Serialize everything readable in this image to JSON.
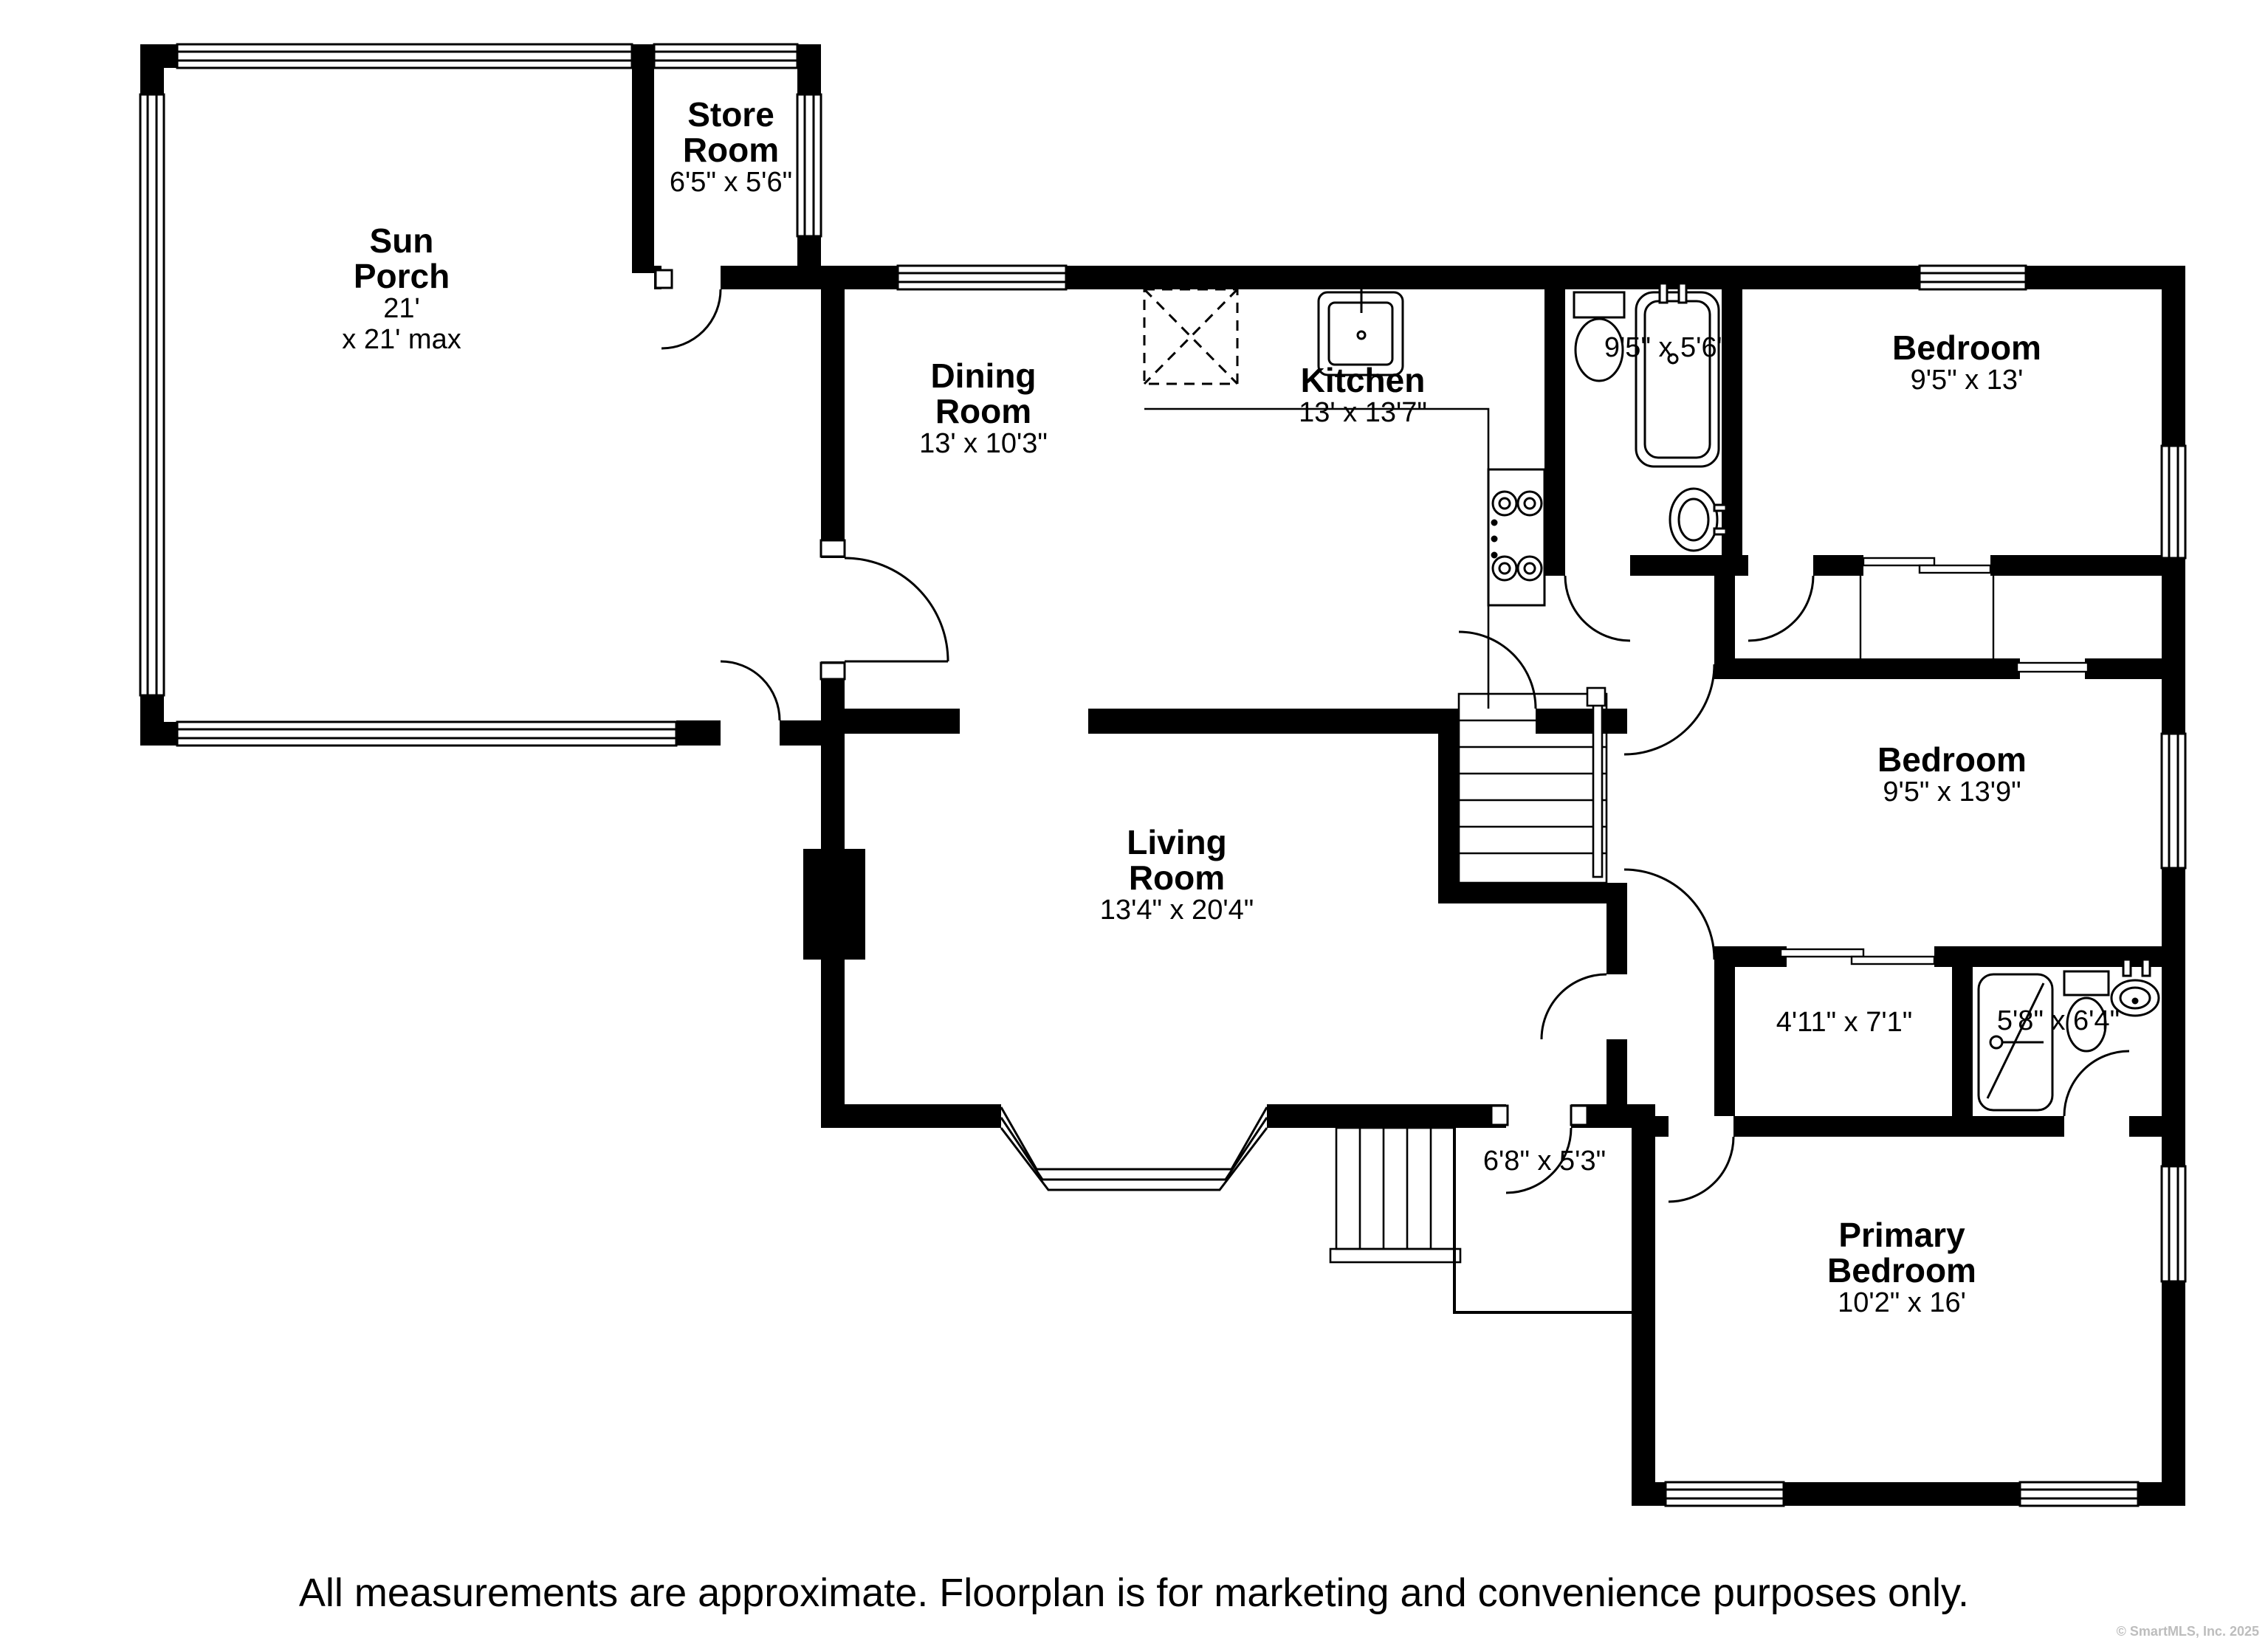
{
  "rooms": {
    "sun_porch": {
      "line1": "Sun",
      "line2": "Porch",
      "dim1": "21'",
      "dim2": "x 21' max"
    },
    "store_room": {
      "line1": "Store",
      "line2": "Room",
      "dims": "6'5\" x 5'6\""
    },
    "dining_room": {
      "line1": "Dining",
      "line2": "Room",
      "dims": "13' x 10'3\""
    },
    "kitchen": {
      "name": "Kitchen",
      "dims": "13' x 13'7\""
    },
    "bathroom_main": {
      "dims": "9'5\" x 5'6\""
    },
    "bedroom_top": {
      "name": "Bedroom",
      "dims": "9'5\" x 13'"
    },
    "bedroom_mid": {
      "name": "Bedroom",
      "dims": "9'5\" x 13'9\""
    },
    "living_room": {
      "line1": "Living",
      "line2": "Room",
      "dims": "13'4\" x 20'4\""
    },
    "closet": {
      "dims": "4'11\" x 7'1\""
    },
    "bathroom_primary": {
      "dims": "5'8\" x 6'4\""
    },
    "entry": {
      "dims": "6'8\" x 5'3\""
    },
    "primary_bedroom": {
      "line1": "Primary",
      "line2": "Bedroom",
      "dims": "10'2\" x 16'"
    }
  },
  "footer": {
    "disclaimer": "All measurements are approximate. Floorplan is for marketing and convenience purposes only.",
    "copyright": "© SmartMLS, Inc. 2025"
  },
  "colors": {
    "wall": "#000000",
    "background": "#ffffff",
    "copyright_gray": "#bdbdbd"
  }
}
